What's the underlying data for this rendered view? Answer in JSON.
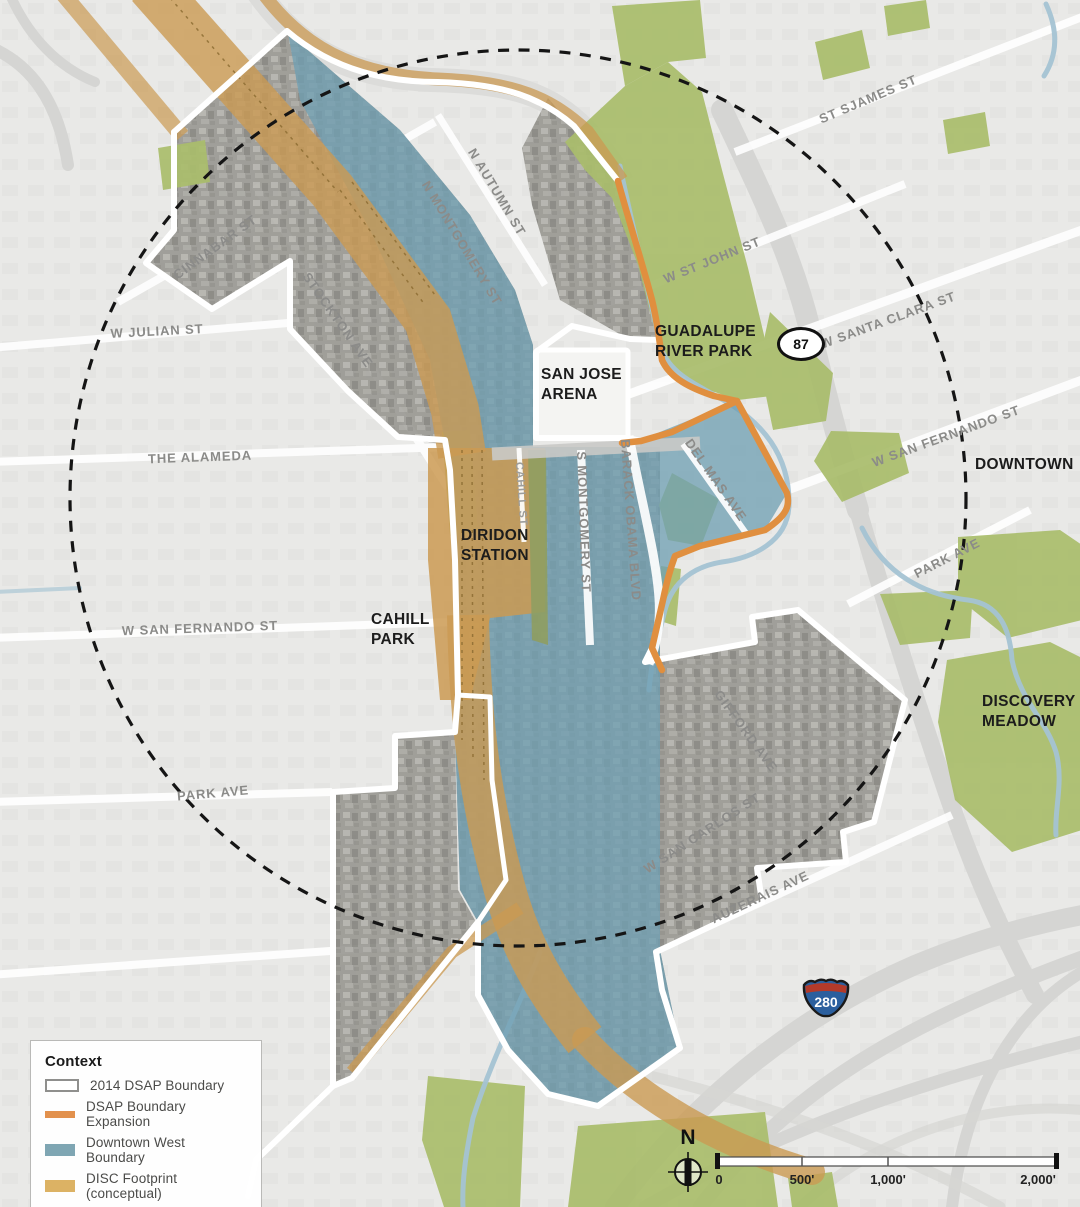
{
  "map": {
    "streets": {
      "cinnabar": "CINNABAR ST",
      "stockton": "STOCKTON AVE",
      "w_julian": "W JULIAN ST",
      "the_alameda": "THE ALAMEDA",
      "w_san_fernando_w": "W SAN FERNANDO ST",
      "park_ave_w": "PARK AVE",
      "n_autumn": "N AUTUMN ST",
      "n_montgomery": "N MONTGOMERY ST",
      "w_st_john": "W ST JOHN ST",
      "st_james": "ST SJAMES ST",
      "w_santa_clara": "W SANTA CLARA ST",
      "w_san_fernando_e": "W SAN FERNANDO ST",
      "park_ave_e": "PARK AVE",
      "del_mas": "DEL MAS AVE",
      "barack_obama": "BARACK OBAMA BLVD",
      "s_montgomery": "S MONTGOMERY ST",
      "cahill_st": "CAHILL ST",
      "gifford": "GIFFORD AVE",
      "w_san_carlos": "W SAN CARLOS ST",
      "auzerais": "AUZERAIS AVE"
    },
    "places": {
      "san_jose_arena": "SAN JOSE\nARENA",
      "guadalupe_river_park": "GUADALUPE\nRIVER PARK",
      "downtown": "DOWNTOWN",
      "diridon_station": "DIRIDON\nSTATION",
      "cahill_park": "CAHILL\nPARK",
      "discovery_meadow": "DISCOVERY\nMEADOW"
    },
    "shields": {
      "route_87": "87",
      "interstate_280": "280"
    },
    "north_arrow_label": "N",
    "scale_bar": {
      "tick_0": "0",
      "tick_500": "500'",
      "tick_1000": "1,000'",
      "tick_2000": "2,000'"
    }
  },
  "legend": {
    "title": "Context",
    "items": [
      {
        "label": "2014 DSAP Boundary",
        "swatch": "outline-white"
      },
      {
        "label": "DSAP Boundary Expansion",
        "swatch": "orange-line"
      },
      {
        "label": "Downtown West Boundary",
        "swatch": "blue-fill"
      },
      {
        "label": "DISC Footprint (conceptual)",
        "swatch": "tan-fill"
      },
      {
        "label": "Half-mile Radius",
        "swatch": "dashed-circle"
      }
    ]
  },
  "colors": {
    "dsap_boundary_white": "#FFFFFF",
    "expansion_orange": "#E2914D",
    "downtown_west_blue": "#7FA6B3",
    "disc_tan": "#DCB264",
    "park_green": "#A9BD6B",
    "half_mile_dash": "#1A1A1A"
  }
}
